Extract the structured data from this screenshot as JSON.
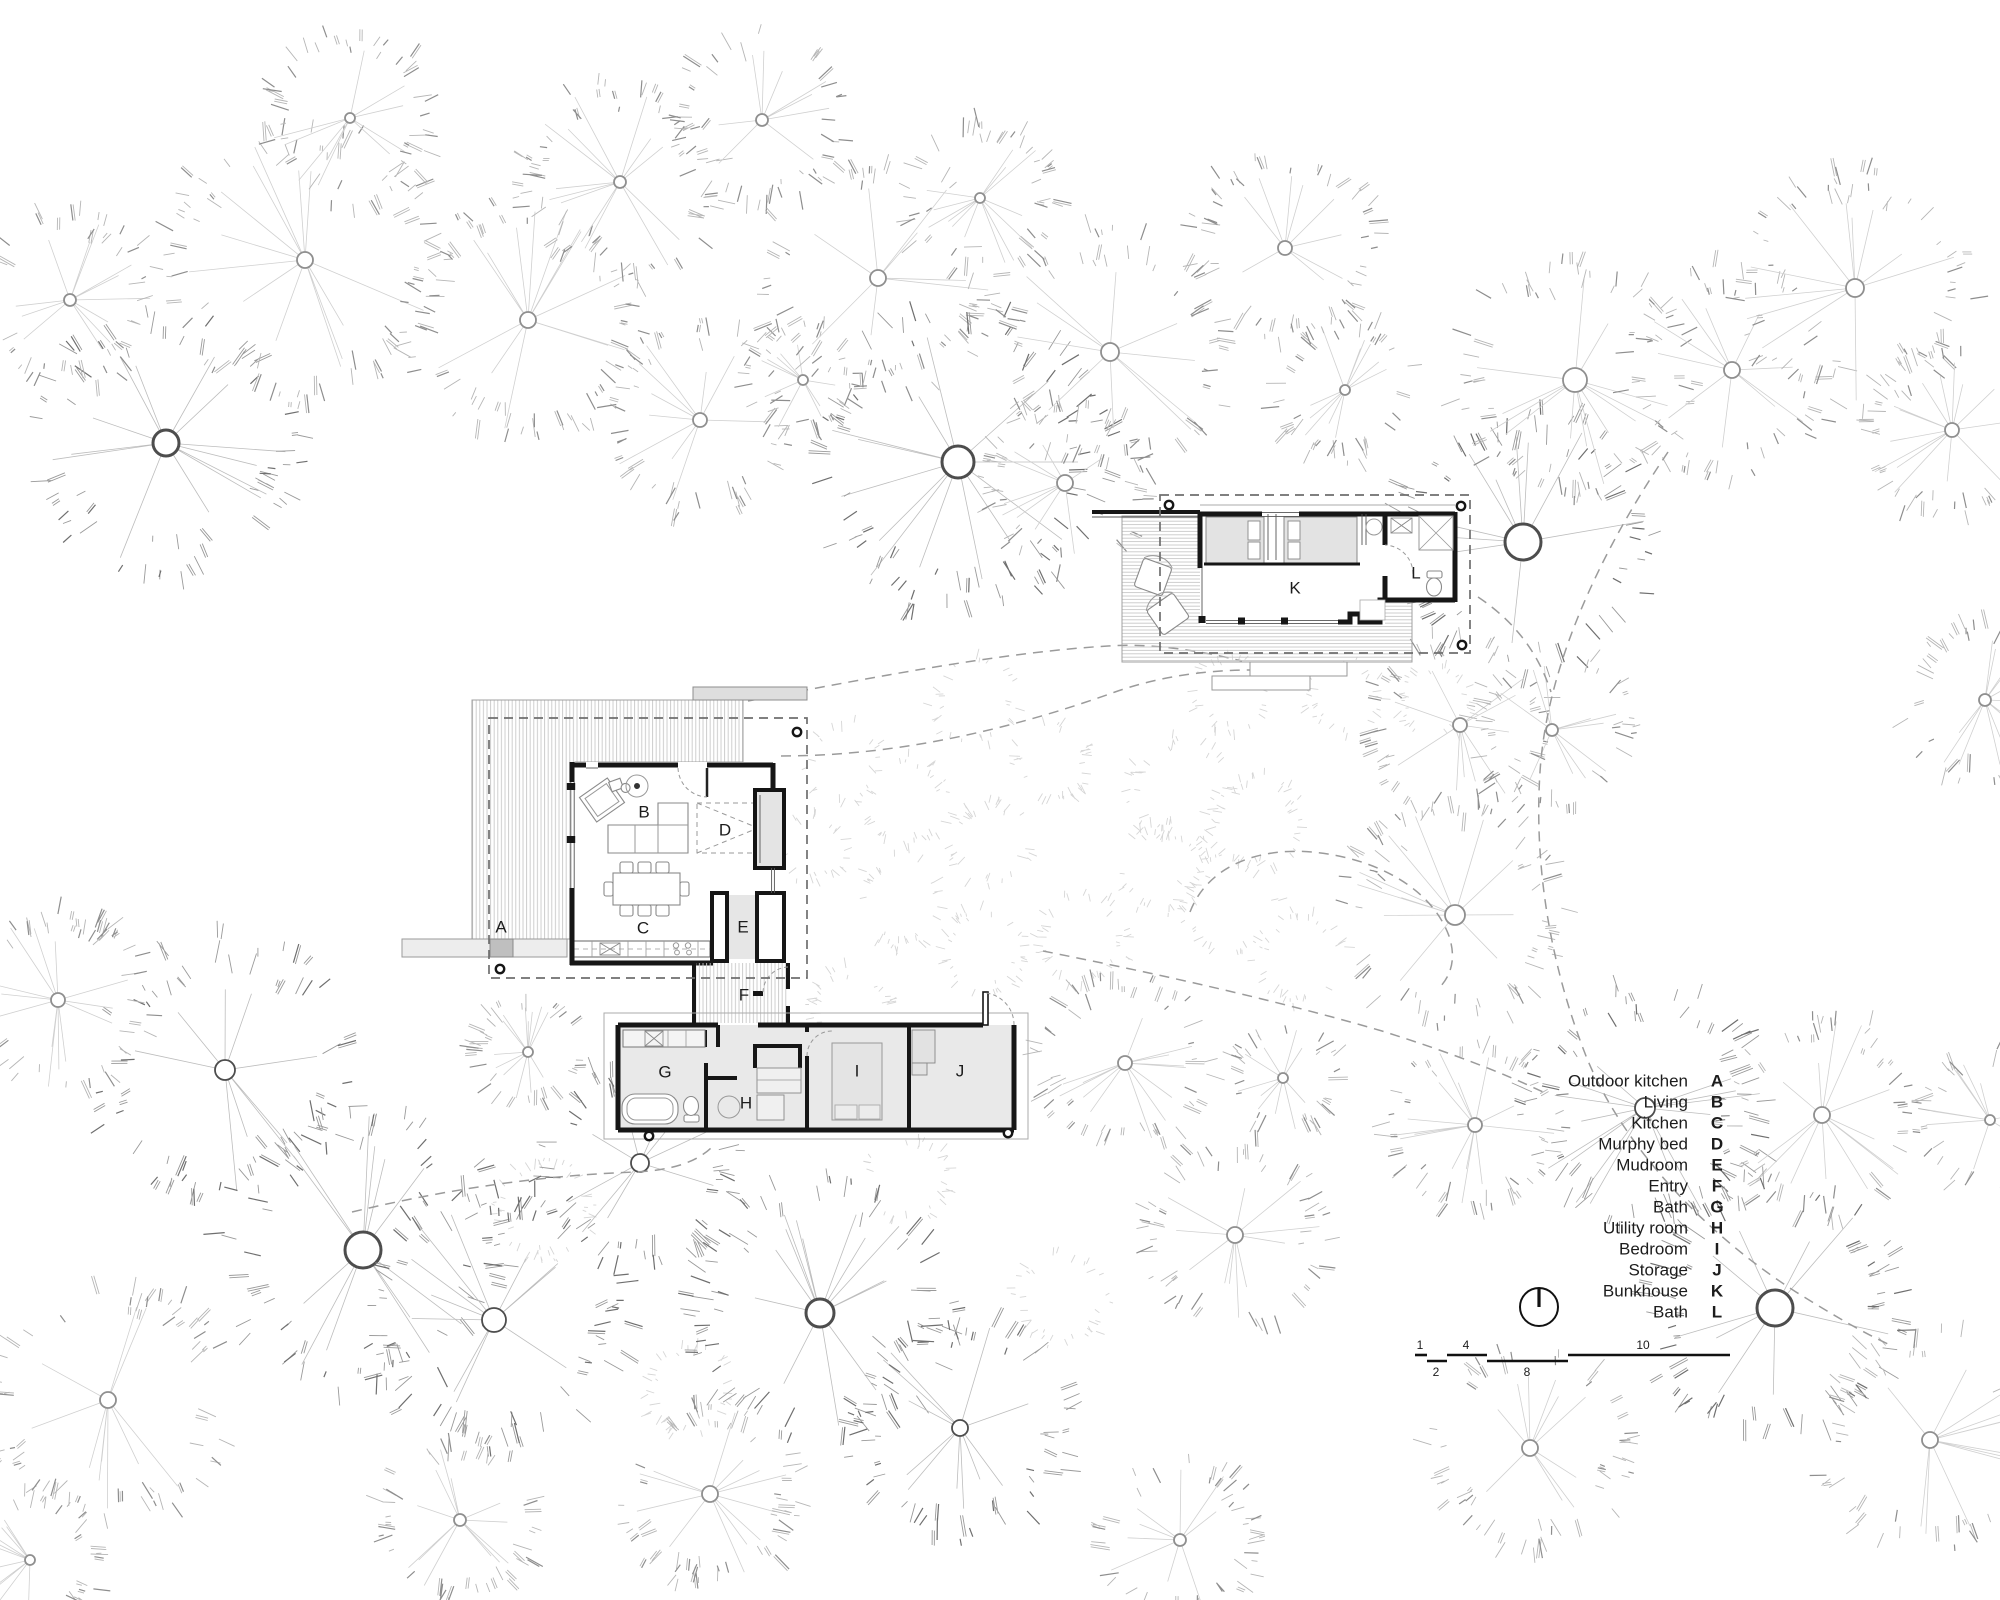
{
  "canvas": {
    "width": 2000,
    "height": 1600,
    "background": "#ffffff"
  },
  "legend": {
    "rows": [
      {
        "name": "Outdoor kitchen",
        "letter": "A"
      },
      {
        "name": "Living",
        "letter": "B"
      },
      {
        "name": "Kitchen",
        "letter": "C"
      },
      {
        "name": "Murphy bed",
        "letter": "D"
      },
      {
        "name": "Mudroom",
        "letter": "E"
      },
      {
        "name": "Entry",
        "letter": "F"
      },
      {
        "name": "Bath",
        "letter": "G"
      },
      {
        "name": "Utility room",
        "letter": "H"
      },
      {
        "name": "Bedroom",
        "letter": "I"
      },
      {
        "name": "Storage",
        "letter": "J"
      },
      {
        "name": "Bunkhouse",
        "letter": "K"
      },
      {
        "name": "Bath",
        "letter": "L"
      }
    ],
    "name_x": 1688,
    "letter_x": 1717,
    "start_y": 1081,
    "row_h": 21,
    "font_px": 17
  },
  "room_labels": [
    {
      "id": "A",
      "x": 501,
      "y": 927
    },
    {
      "id": "B",
      "x": 644,
      "y": 812
    },
    {
      "id": "C",
      "x": 643,
      "y": 928
    },
    {
      "id": "D",
      "x": 725,
      "y": 830
    },
    {
      "id": "E",
      "x": 743,
      "y": 927
    },
    {
      "id": "F",
      "x": 744,
      "y": 995
    },
    {
      "id": "G",
      "x": 665,
      "y": 1072
    },
    {
      "id": "H",
      "x": 746,
      "y": 1103
    },
    {
      "id": "I",
      "x": 857,
      "y": 1071
    },
    {
      "id": "J",
      "x": 960,
      "y": 1071
    },
    {
      "id": "K",
      "x": 1295,
      "y": 588
    },
    {
      "id": "L",
      "x": 1416,
      "y": 573
    }
  ],
  "north_arrow": {
    "cx": 1539,
    "cy": 1307,
    "r": 19
  },
  "scale_bar": {
    "top_y": 1355,
    "bot_y": 1361,
    "segments": [
      {
        "row": "top",
        "x1": 1415,
        "x2": 1427,
        "label": "1",
        "lx": 1420
      },
      {
        "row": "bot",
        "x1": 1427,
        "x2": 1447,
        "label": "2",
        "lx": 1436
      },
      {
        "row": "top",
        "x1": 1447,
        "x2": 1487,
        "label": "4",
        "lx": 1466
      },
      {
        "row": "bot",
        "x1": 1487,
        "x2": 1568,
        "label": "8",
        "lx": 1527
      },
      {
        "row": "top",
        "x1": 1568,
        "x2": 1730,
        "label": "10",
        "lx": 1643
      }
    ]
  },
  "site_paths": [
    "M748,701 C880,676 1005,652 1108,646 C1152,643 1196,650 1242,661",
    "M781,756 C900,756 1015,728 1115,692 C1152,679 1198,670 1252,670",
    "M1668,452 C1603,548 1547,662 1540,772 C1534,862 1549,962 1586,1056 C1617,1133 1690,1224 1796,1292 C1833,1315 1862,1332 1888,1344",
    "M1190,912 C1206,870 1252,847 1312,852 C1377,858 1432,889 1449,936 C1456,957 1452,974 1440,987",
    "M1043,951 C1133,969 1262,996 1382,1031 C1452,1053 1503,1073 1543,1092",
    "M352,1212 C452,1188 547,1175 636,1172 C673,1170 696,1162 711,1148",
    "M1478,597 C1514,621 1538,652 1551,692"
  ],
  "trees": {
    "canopy": [
      [
        166,
        443,
        130,
        13,
        2
      ],
      [
        70,
        300,
        85,
        6,
        1
      ],
      [
        305,
        260,
        140,
        8,
        1
      ],
      [
        350,
        118,
        85,
        5,
        1
      ],
      [
        528,
        320,
        120,
        8,
        1
      ],
      [
        620,
        182,
        100,
        6,
        1
      ],
      [
        762,
        120,
        85,
        6,
        1
      ],
      [
        700,
        420,
        95,
        7,
        1
      ],
      [
        803,
        380,
        55,
        5,
        1
      ],
      [
        878,
        278,
        115,
        8,
        1
      ],
      [
        980,
        198,
        75,
        5,
        1
      ],
      [
        958,
        462,
        150,
        16,
        2
      ],
      [
        1065,
        483,
        85,
        8,
        1
      ],
      [
        1110,
        352,
        120,
        9,
        1
      ],
      [
        1285,
        248,
        95,
        7,
        1
      ],
      [
        1345,
        390,
        70,
        5,
        1
      ],
      [
        1523,
        542,
        130,
        18,
        2
      ],
      [
        1575,
        380,
        115,
        12,
        1
      ],
      [
        1732,
        370,
        105,
        8,
        1
      ],
      [
        1855,
        288,
        115,
        9,
        1
      ],
      [
        1952,
        430,
        90,
        7,
        1
      ],
      [
        1985,
        700,
        80,
        6,
        1
      ],
      [
        1460,
        725,
        90,
        7,
        1
      ],
      [
        1552,
        730,
        80,
        6,
        1
      ],
      [
        1455,
        915,
        110,
        10,
        1
      ],
      [
        1645,
        1108,
        120,
        10,
        2
      ],
      [
        1822,
        1115,
        100,
        8,
        1
      ],
      [
        1775,
        1308,
        130,
        18,
        2
      ],
      [
        1475,
        1125,
        85,
        7,
        1
      ],
      [
        1930,
        1440,
        110,
        8,
        1
      ],
      [
        1530,
        1448,
        100,
        8,
        1
      ],
      [
        225,
        1070,
        130,
        10,
        2
      ],
      [
        363,
        1250,
        140,
        18,
        2
      ],
      [
        494,
        1320,
        130,
        12,
        2
      ],
      [
        640,
        1163,
        100,
        9,
        2
      ],
      [
        820,
        1313,
        130,
        14,
        2
      ],
      [
        960,
        1428,
        110,
        8,
        2
      ],
      [
        710,
        1494,
        90,
        8,
        1
      ],
      [
        108,
        1400,
        120,
        8,
        1
      ],
      [
        58,
        1000,
        90,
        7,
        1
      ],
      [
        1125,
        1063,
        85,
        7,
        1
      ],
      [
        1235,
        1235,
        90,
        8,
        1
      ],
      [
        1283,
        1078,
        55,
        5,
        1
      ],
      [
        30,
        1560,
        70,
        5,
        1
      ],
      [
        460,
        1520,
        80,
        6,
        1
      ],
      [
        1180,
        1540,
        80,
        6,
        1
      ],
      [
        1990,
        1120,
        70,
        5,
        1
      ],
      [
        528,
        1052,
        52,
        5,
        1
      ]
    ],
    "rings": [
      [
        1180,
        790,
        46
      ],
      [
        1255,
        822,
        42
      ],
      [
        1162,
        868,
        40
      ],
      [
        1228,
        906,
        46
      ],
      [
        905,
        800,
        40
      ],
      [
        990,
        842,
        36
      ],
      [
        846,
        762,
        36
      ],
      [
        1082,
        940,
        42
      ],
      [
        1300,
        958,
        40
      ],
      [
        1230,
        692,
        34
      ],
      [
        1345,
        697,
        34
      ],
      [
        1436,
        700,
        32
      ],
      [
        545,
        1210,
        44
      ],
      [
        690,
        1390,
        40
      ],
      [
        1062,
        1300,
        42
      ],
      [
        908,
        1180,
        38
      ],
      [
        975,
        702,
        38
      ],
      [
        1052,
        762,
        34
      ],
      [
        900,
        902,
        40
      ],
      [
        982,
        952,
        38
      ],
      [
        850,
        1008,
        36
      ],
      [
        812,
        848,
        30
      ]
    ]
  },
  "colors": {
    "wall": "#161616",
    "room_fill": "#e9e9e9",
    "gray_fill": "#e3e3e3",
    "hatch": "#c9c9c9",
    "dashed": "#6e6e6e",
    "tree_dark": "#6f6f6f",
    "tree_light": "#b6b6b6"
  }
}
